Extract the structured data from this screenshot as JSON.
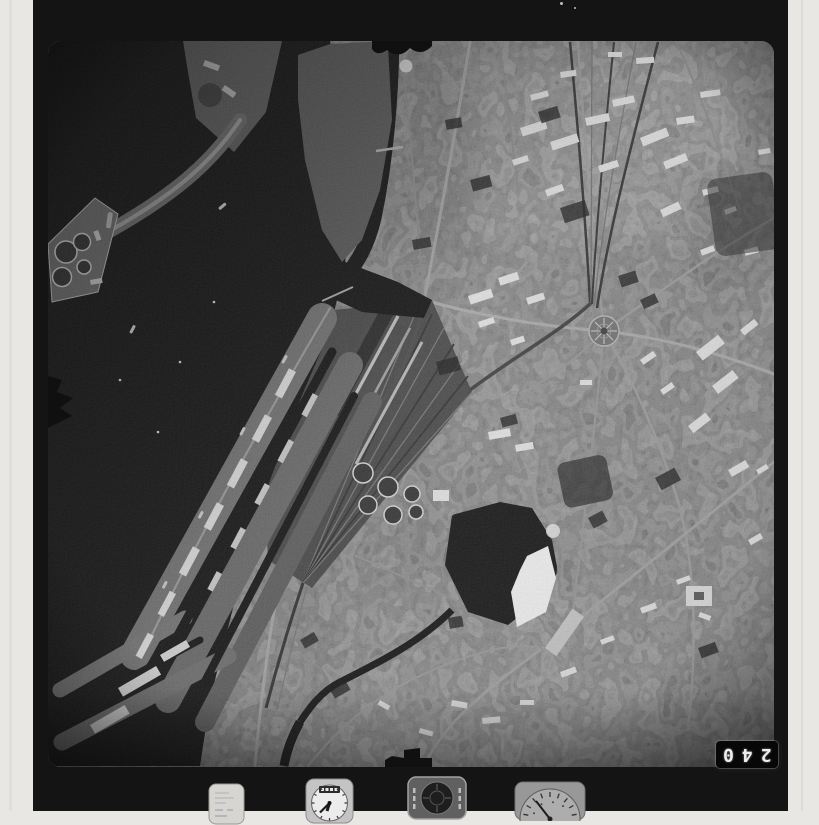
{
  "scan": {
    "margin_color": "#e9e7e4",
    "film_color": "#141414",
    "description": "Scanned black-and-white vertical aerial survey photograph of a harbor city: dark harbor water with a curving breakwater, tank farm and finger quays on the left; dense city fabric with radiating streets, a circular plaza, railway yards and a small lake with bright sun glint on the right."
  },
  "photo": {
    "frame_number": "240"
  },
  "instruments": {
    "items": [
      {
        "label": "data pad"
      },
      {
        "label": "clock"
      },
      {
        "label": "level indicator"
      },
      {
        "label": "altimeter"
      }
    ]
  },
  "fiducials": {
    "items": [
      {
        "label": "top edge mark"
      },
      {
        "label": "left edge mark"
      },
      {
        "label": "bottom edge mark"
      }
    ]
  }
}
